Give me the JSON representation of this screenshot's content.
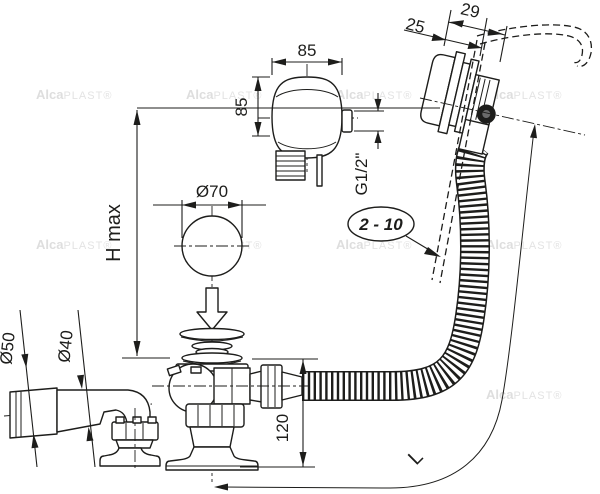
{
  "diagram": {
    "brand": {
      "bold": "Alca",
      "rest": "PLAST®"
    },
    "labels": {
      "head_width": "85",
      "head_height": "85",
      "thread": "G1/2\"",
      "rim_offset_outer": "29",
      "rim_offset_inner": "25",
      "wall_thickness_range": "2 - 10",
      "max_height": "H max",
      "plug_diameter": "Ø70",
      "sleeve_diameter": "Ø50",
      "pipe_diameter": "Ø40",
      "trap_height": "120",
      "hose_length": "L"
    },
    "colors": {
      "line": "#1d1d1b",
      "watermark": "#dedede",
      "background": "#ffffff"
    }
  }
}
